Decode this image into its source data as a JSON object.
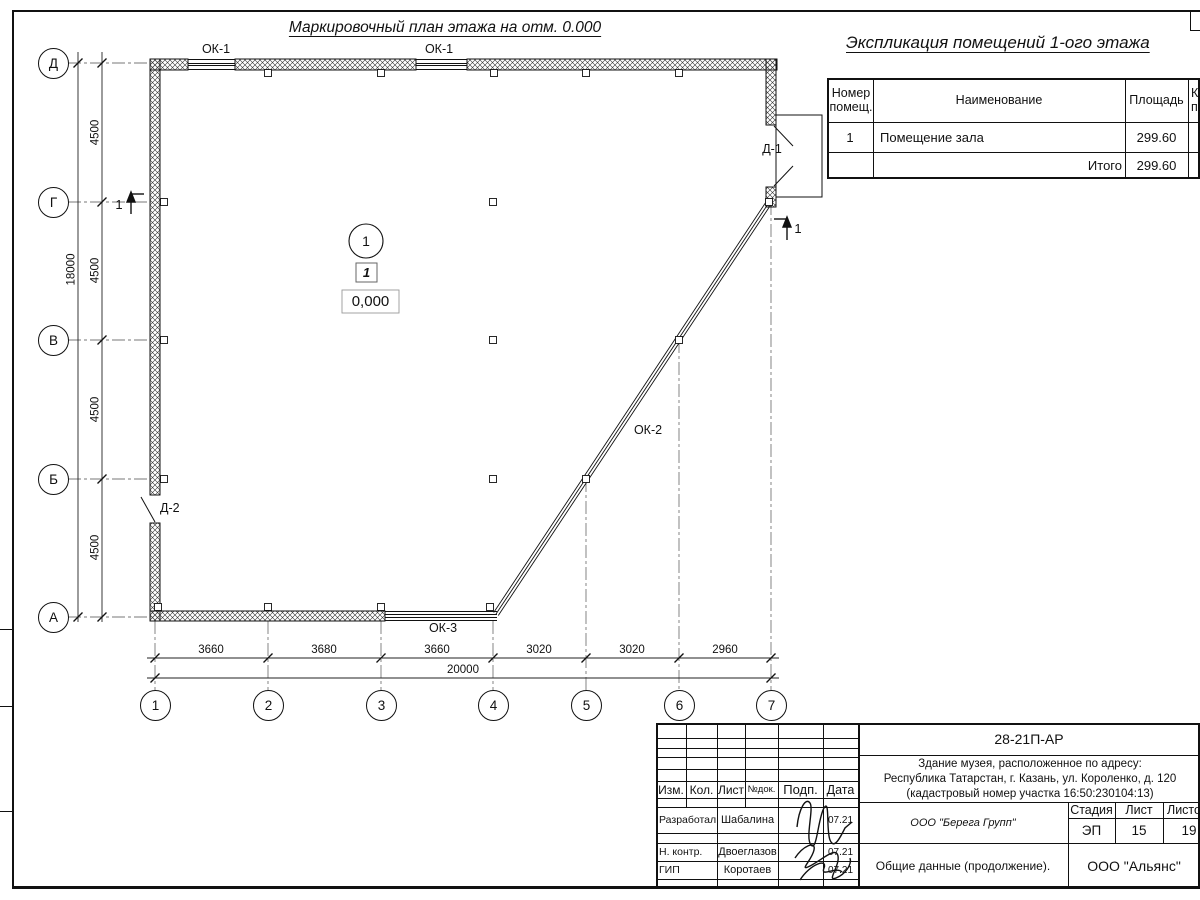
{
  "plan": {
    "title": "Маркировочный план этажа на отм. 0.000",
    "axes": {
      "rows": [
        "Д",
        "Г",
        "В",
        "Б",
        "А"
      ],
      "cols": [
        "1",
        "2",
        "3",
        "4",
        "5",
        "6",
        "7"
      ]
    },
    "dims": {
      "row_segments": [
        "4500",
        "4500",
        "4500",
        "4500"
      ],
      "row_total": "18000",
      "col_segments": [
        "3660",
        "3680",
        "3660",
        "3020",
        "3020",
        "2960"
      ],
      "col_total": "20000"
    },
    "labels": {
      "window1a": "ОК-1",
      "window1b": "ОК-1",
      "window2": "ОК-2",
      "window3": "ОК-3",
      "door1": "Д-1",
      "door2": "Д-2",
      "section_left": "1",
      "section_right": "1"
    },
    "room": {
      "number": "1",
      "mark": "1",
      "level": "0,000"
    }
  },
  "explication": {
    "title": "Экспликация помещений 1-ого этажа",
    "col_number_l1": "Номер",
    "col_number_l2": "помещ.",
    "col_name": "Наименование",
    "col_area": "Площадь",
    "col_cut_l1": "Ка",
    "col_cut_l2": "по",
    "row1": {
      "number": "1",
      "name": "Помещение зала",
      "area": "299.60"
    },
    "total": {
      "label": "Итого",
      "area": "299.60"
    }
  },
  "titleblock": {
    "doc_code": "28-21П-АР",
    "object_l1": "Здание музея, расположенное по адресу:",
    "object_l2": "Республика Татарстан, г. Казань, ул. Короленко, д. 120",
    "object_l3": "(кадастровый номер участка 16:50:230104:13)",
    "cols": {
      "izm": "Изм.",
      "kol": "Кол.",
      "list": "Лист",
      "ndok": "№док.",
      "podp": "Подп.",
      "data": "Дата"
    },
    "roles": [
      {
        "role": "Разработал",
        "name": "Шабалина",
        "date": "07.21"
      },
      {
        "role": "Н. контр.",
        "name": "Двоеглазов",
        "date": "07.21"
      },
      {
        "role": "ГИП",
        "name": "Коротаев",
        "date": "07.21"
      }
    ],
    "company": "ООО \"Берега Групп\"",
    "stage_label": "Стадия",
    "stage": "ЭП",
    "sheet_label": "Лист",
    "sheet": "15",
    "sheets_label": "Листов",
    "sheets": "19",
    "doc_name": "Общие данные (продолжение).",
    "org": "ООО \"Альянс\""
  }
}
